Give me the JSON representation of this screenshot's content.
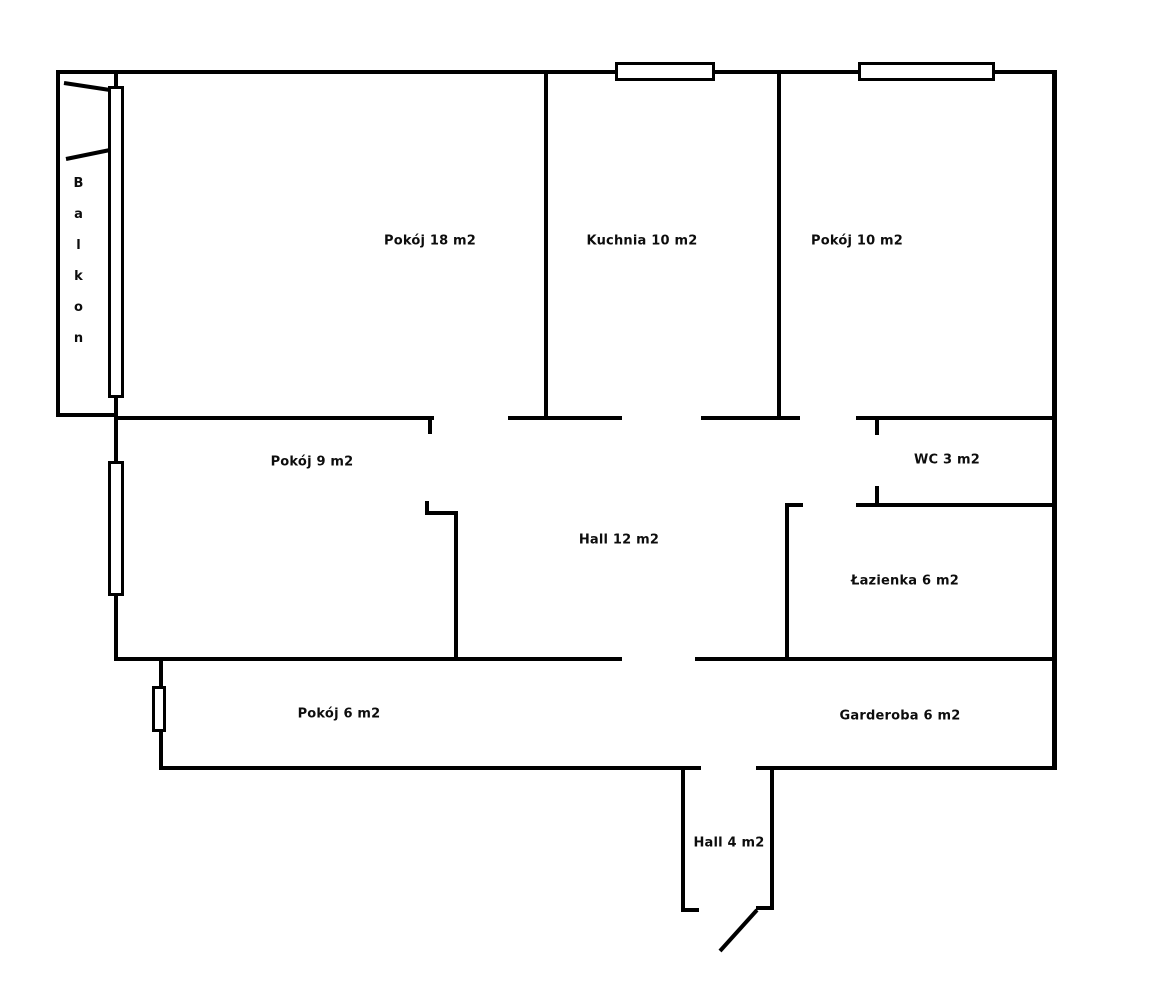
{
  "diagram": {
    "type": "floor-plan",
    "background_color": "#ffffff",
    "wall_color": "#000000",
    "text_color": "#0d0d0d"
  },
  "balcony": {
    "label": "Balkon",
    "letters": [
      "B",
      "a",
      "l",
      "k",
      "o",
      "n"
    ]
  },
  "rooms": {
    "pokoj18": {
      "name": "Pokój",
      "area": "18 m2",
      "label": "Pokój 18 m2"
    },
    "kuchnia": {
      "name": "Kuchnia",
      "area": "10 m2",
      "label": "Kuchnia 10 m2"
    },
    "pokoj10": {
      "name": "Pokój",
      "area": "10 m2",
      "label": "Pokój 10 m2"
    },
    "pokoj9": {
      "name": "Pokój",
      "area": "9 m2",
      "label": "Pokój 9 m2"
    },
    "wc": {
      "name": "WC",
      "area": "3 m2",
      "label": "WC 3 m2"
    },
    "hall12": {
      "name": "Hall",
      "area": "12 m2",
      "label": "Hall 12 m2"
    },
    "lazienka": {
      "name": "Łazienka",
      "area": "6 m2",
      "label": "Łazienka 6 m2"
    },
    "pokoj6": {
      "name": "Pokój",
      "area": "6 m2",
      "label": "Pokój 6 m2"
    },
    "garderoba": {
      "name": "Garderoba",
      "area": "6 m2",
      "label": "Garderoba 6 m2"
    },
    "hall4": {
      "name": "Hall",
      "area": "4 m2",
      "label": "Hall 4 m2"
    }
  }
}
